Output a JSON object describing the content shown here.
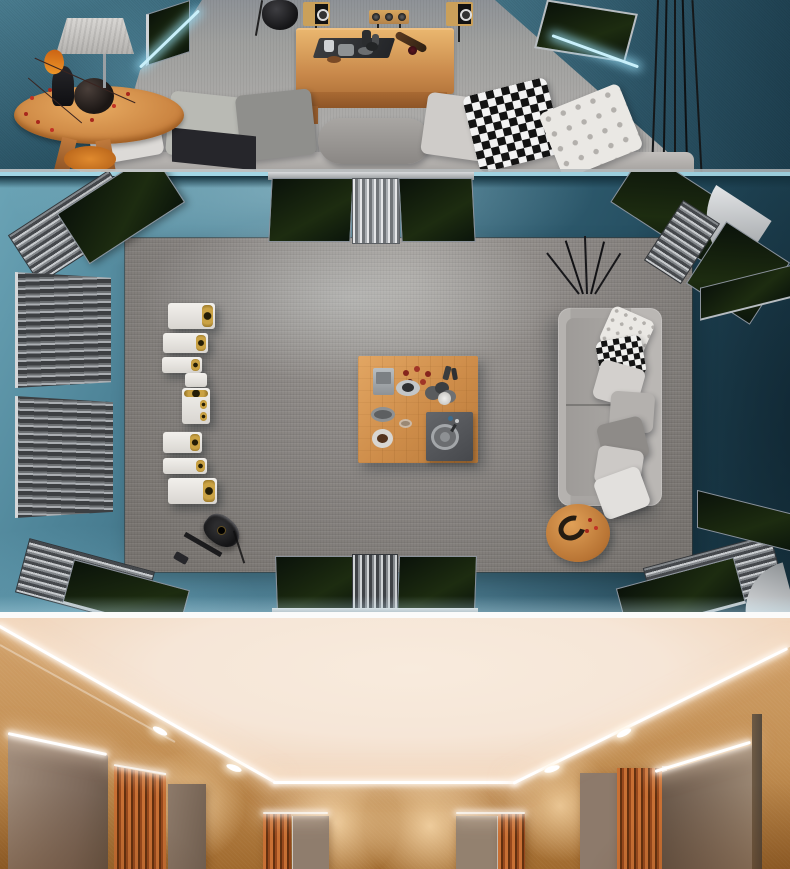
{
  "meta": {
    "title": "Acoustic listening room interiors — three stacked renders",
    "width": 790,
    "height": 869
  },
  "panels": [
    {
      "name": "top-room-eye-level",
      "description": "Eye-level render of a teal fabric-walled listening room: round wooden side table with fabric lamp, black vases, orange flower and red berry branch; low wooden coffee table with dark tray, cups and wine bottle; two wood bookshelf speakers and a center channel on stands; hanging black egg chair; gray sofa with white, gray, black-and-white gingham and diamond-patterned pillows; dark acoustic wall panels with cyan LED backlight"
    },
    {
      "name": "top-down-room-plan",
      "description": "Top-down render of the teal listening room: gray carpet rug on teal velvet floor, column of seven white-and-gold speakers, square wooden coffee table with radio, coffee cups, bowls and dark tray, gray two-seat sofa with seven pillows, round wooden side table, black electric guitar, black twig decor, corner bass traps with metal diffusers, slatted wall diffusers and a metal curtain diffuser"
    },
    {
      "name": "beige-theater-room",
      "description": "Render of a warm beige home-theater room: cream ceiling with white LED cove strip and recessed downlights, scallop-lit tan fabric walls, taupe fabric acoustic panels with orange wood-slat sections on left, back and right walls"
    }
  ],
  "objects": {
    "speaker_count_top_down": 7,
    "sofa_pillow_count_top_down": 7,
    "corner_bass_traps": 4,
    "downlight_count": 4
  },
  "colors": {
    "teal_wall": "#3d6e81",
    "teal_wall_dark": "#1f4150",
    "teal_floor_light": "#6ba4b6",
    "teal_floor_dark": "#183643",
    "led_cyan": "#c9f0fb",
    "carpet_gray": "#9d9c9a",
    "rug_gray": "#8b8784",
    "sofa_gray": "#a8a5a2",
    "pillow_white": "#eae8e4",
    "pillow_dark": "#8e8b88",
    "wood_light": "#e2a663",
    "wood_dark": "#a96f33",
    "panel_green_black": "#0d180d",
    "metal_silver": "#c7cacd",
    "speaker_white": "#f2f0ec",
    "speaker_gold": "#caa244",
    "guitar_black": "#141416",
    "berry_red": "#a8271c",
    "flower_orange": "#e07b1f",
    "ceiling_cream": "#f6e6d7",
    "wall_tan": "#c28f53",
    "panel_taupe": "#8d7a6b",
    "slat_orange": "#b05f28",
    "led_white": "#ffffff",
    "seam_white": "#fbfbfa"
  }
}
